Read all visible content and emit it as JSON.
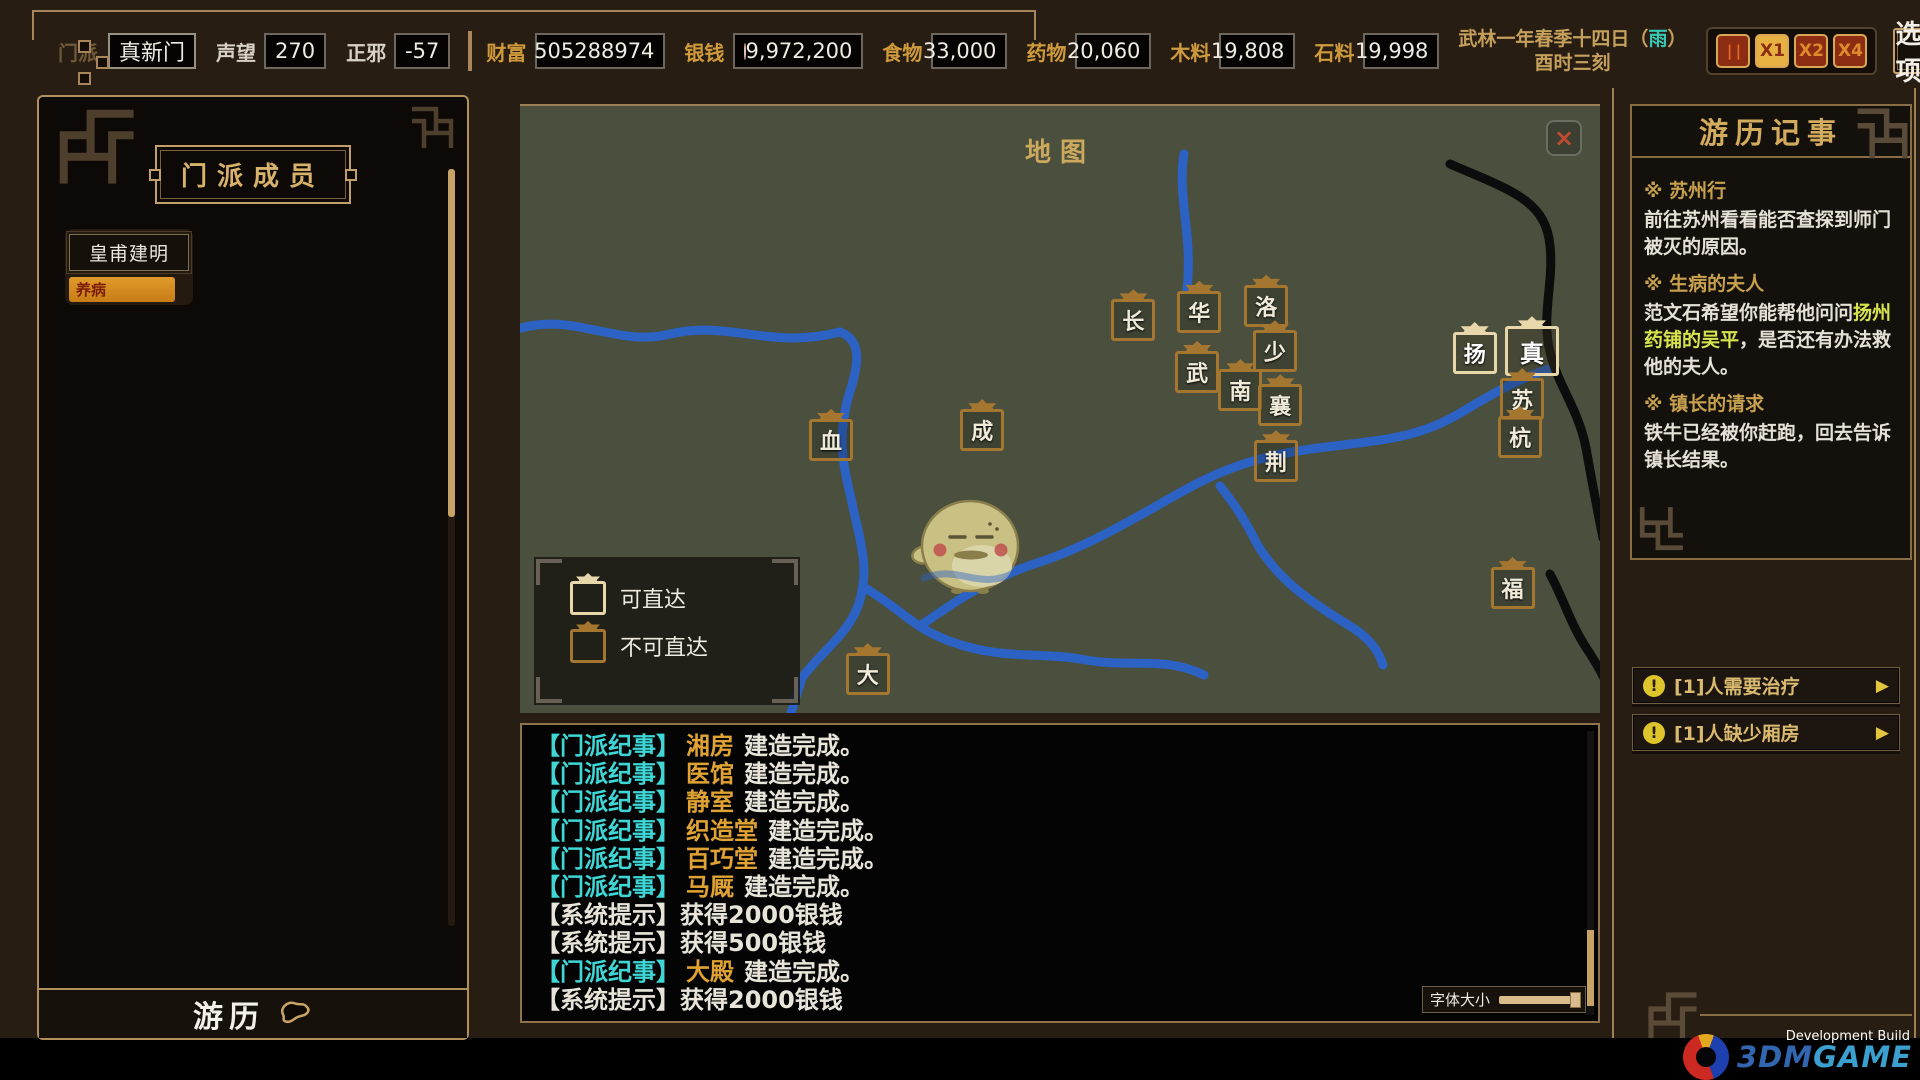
{
  "top_bar": {
    "sect_label": "门派",
    "sect_name": "真新门",
    "stats": [
      {
        "label": "声望",
        "value": "270"
      },
      {
        "label": "正邪",
        "value": "-57"
      }
    ],
    "resources": [
      {
        "label": "财富",
        "value": "505288974",
        "coin": false,
        "wide": true
      },
      {
        "label": "银钱",
        "value": "9,972,200",
        "coin": true,
        "wide": true
      },
      {
        "label": "食物",
        "value": "33,000",
        "coin": false,
        "wide": false
      },
      {
        "label": "药物",
        "value": "20,060",
        "coin": false,
        "wide": false
      },
      {
        "label": "木料",
        "value": "19,808",
        "coin": false,
        "wide": false
      },
      {
        "label": "石料",
        "value": "19,998",
        "coin": false,
        "wide": false
      }
    ],
    "date_line1_pre": "武林一年春季十四日（",
    "weather": "雨",
    "date_line1_post": "）",
    "date_line2": "酉时三刻",
    "speed_buttons": [
      {
        "label": "| |",
        "cls": "pause"
      },
      {
        "label": "X1",
        "cls": "active"
      },
      {
        "label": "X2",
        "cls": "normal"
      },
      {
        "label": "X4",
        "cls": "normal"
      }
    ],
    "options_label": "选项"
  },
  "left_panel": {
    "title": "门派成员",
    "members": [
      {
        "name": "皇甫建明",
        "status": "养病"
      }
    ],
    "travel_label": "游历"
  },
  "map": {
    "title": "地图",
    "close_label": "×",
    "legend": [
      {
        "label": "可直达",
        "reachable": true
      },
      {
        "label": "不可直达",
        "reachable": false
      }
    ],
    "markers": [
      {
        "char": "长",
        "x": 56.8,
        "y": 35.3,
        "reachable": false,
        "big": false
      },
      {
        "char": "华",
        "x": 62.9,
        "y": 33.9,
        "reachable": false,
        "big": false
      },
      {
        "char": "洛",
        "x": 69.1,
        "y": 32.9,
        "reachable": false,
        "big": false
      },
      {
        "char": "少",
        "x": 69.9,
        "y": 40.4,
        "reachable": false,
        "big": false
      },
      {
        "char": "武",
        "x": 62.7,
        "y": 43.8,
        "reachable": false,
        "big": false
      },
      {
        "char": "南",
        "x": 66.7,
        "y": 46.8,
        "reachable": false,
        "big": false
      },
      {
        "char": "襄",
        "x": 70.4,
        "y": 49.3,
        "reachable": false,
        "big": false
      },
      {
        "char": "成",
        "x": 42.8,
        "y": 53.4,
        "reachable": false,
        "big": false
      },
      {
        "char": "血",
        "x": 28.8,
        "y": 55.0,
        "reachable": false,
        "big": false
      },
      {
        "char": "荆",
        "x": 70.0,
        "y": 58.5,
        "reachable": false,
        "big": false
      },
      {
        "char": "扬",
        "x": 88.4,
        "y": 40.7,
        "reachable": true,
        "big": false
      },
      {
        "char": "真",
        "x": 93.7,
        "y": 40.4,
        "reachable": true,
        "big": true
      },
      {
        "char": "苏",
        "x": 92.8,
        "y": 48.3,
        "reachable": false,
        "big": false
      },
      {
        "char": "杭",
        "x": 92.6,
        "y": 54.5,
        "reachable": false,
        "big": false
      },
      {
        "char": "福",
        "x": 91.9,
        "y": 79.4,
        "reachable": false,
        "big": false
      },
      {
        "char": "大",
        "x": 32.2,
        "y": 93.6,
        "reachable": false,
        "big": false
      }
    ]
  },
  "log": {
    "lines": [
      {
        "tag": "【门派纪事】",
        "tag_class": "tag-sect",
        "subject": "湘房",
        "text": "建造完成。"
      },
      {
        "tag": "【门派纪事】",
        "tag_class": "tag-sect",
        "subject": "医馆",
        "text": "建造完成。"
      },
      {
        "tag": "【门派纪事】",
        "tag_class": "tag-sect",
        "subject": "静室",
        "text": "建造完成。"
      },
      {
        "tag": "【门派纪事】",
        "tag_class": "tag-sect",
        "subject": "织造堂",
        "text": "建造完成。"
      },
      {
        "tag": "【门派纪事】",
        "tag_class": "tag-sect",
        "subject": "百巧堂",
        "text": "建造完成。"
      },
      {
        "tag": "【门派纪事】",
        "tag_class": "tag-sect",
        "subject": "马厩",
        "text": "建造完成。"
      },
      {
        "tag": "【系统提示】",
        "tag_class": "tag-sys",
        "subject": "",
        "text": "获得2000银钱"
      },
      {
        "tag": "【系统提示】",
        "tag_class": "tag-sys",
        "subject": "",
        "text": "获得500银钱"
      },
      {
        "tag": "【门派纪事】",
        "tag_class": "tag-sect",
        "subject": "大殿",
        "text": "建造完成。"
      },
      {
        "tag": "【系统提示】",
        "tag_class": "tag-sys",
        "subject": "",
        "text": "获得2000银钱"
      }
    ],
    "font_size_label": "字体大小"
  },
  "right_panel": {
    "journal_title": "游历记事",
    "quests": [
      {
        "title": "※ 苏州行",
        "pre": "前往苏州看看能否查探到师门被灭的原因。",
        "hl": "",
        "post": ""
      },
      {
        "title": "※ 生病的夫人",
        "pre": "范文石希望你能帮他问问",
        "hl": "扬州药铺的吴平",
        "post": "，是否还有办法救他的夫人。"
      },
      {
        "title": "※ 镇长的请求",
        "pre": "铁牛已经被你赶跑，回去告诉镇长结果。",
        "hl": "",
        "post": ""
      }
    ],
    "notifications": [
      {
        "icon": "!",
        "text": "[1]人需要治疗",
        "arrow": "▶"
      },
      {
        "icon": "!",
        "text": "[1]人缺少厢房",
        "arrow": "▶"
      }
    ]
  },
  "footer": {
    "dev_build": "Development Build",
    "logo_3dm": "3DM",
    "logo_game": "GAME"
  },
  "colors": {
    "accent_gold": "#c9a364",
    "log_tag_cyan": "#3fd6d6",
    "building_orange": "#dfa233",
    "quest_highlight": "#d6e44e",
    "status_orange": "#d98c1f",
    "weather_teal": "#35c8b4",
    "map_green": "#4a4f3e",
    "river_blue": "#2b62c4"
  }
}
